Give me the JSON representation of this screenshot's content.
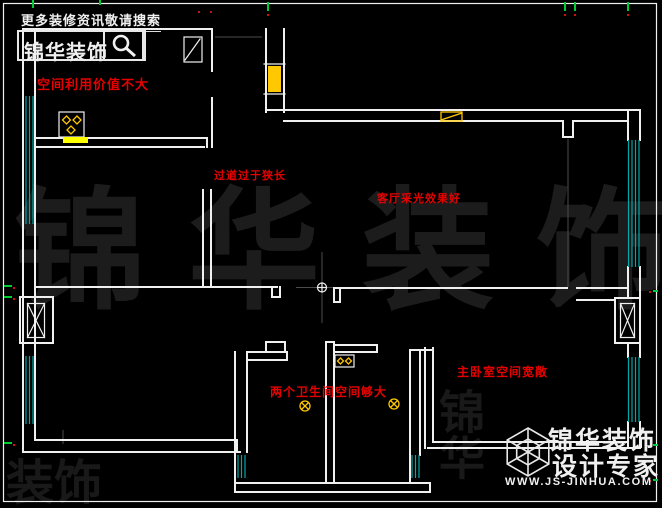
{
  "header": {
    "search_hint": "更多装修资讯敬请搜索",
    "brand_name": "锦华装饰"
  },
  "annotations": {
    "kitchen": "空间利用价值不大",
    "corridor": "过道过于狭长",
    "living_room": "客厅采光效果好",
    "bathrooms": "两个卫生间空间够大",
    "master_bedroom": "主卧室空间宽敞"
  },
  "watermark": {
    "main": "锦华装饰",
    "partial_top": "锦华",
    "partial_bottom": "装饰"
  },
  "footer": {
    "brand_line1": "锦华装饰",
    "brand_line2": "设计专家",
    "website": "WWW.JS-JINHUA.COM"
  },
  "colors": {
    "background": "#000000",
    "wall": "#f0f0f0",
    "annotation_red": "#e60000",
    "window_cyan": "#00a8a8",
    "fixture_yellow": "#ffc800",
    "stove_bar_yellow": "#ffff00",
    "watermark_gray": "#1c1c1c"
  }
}
